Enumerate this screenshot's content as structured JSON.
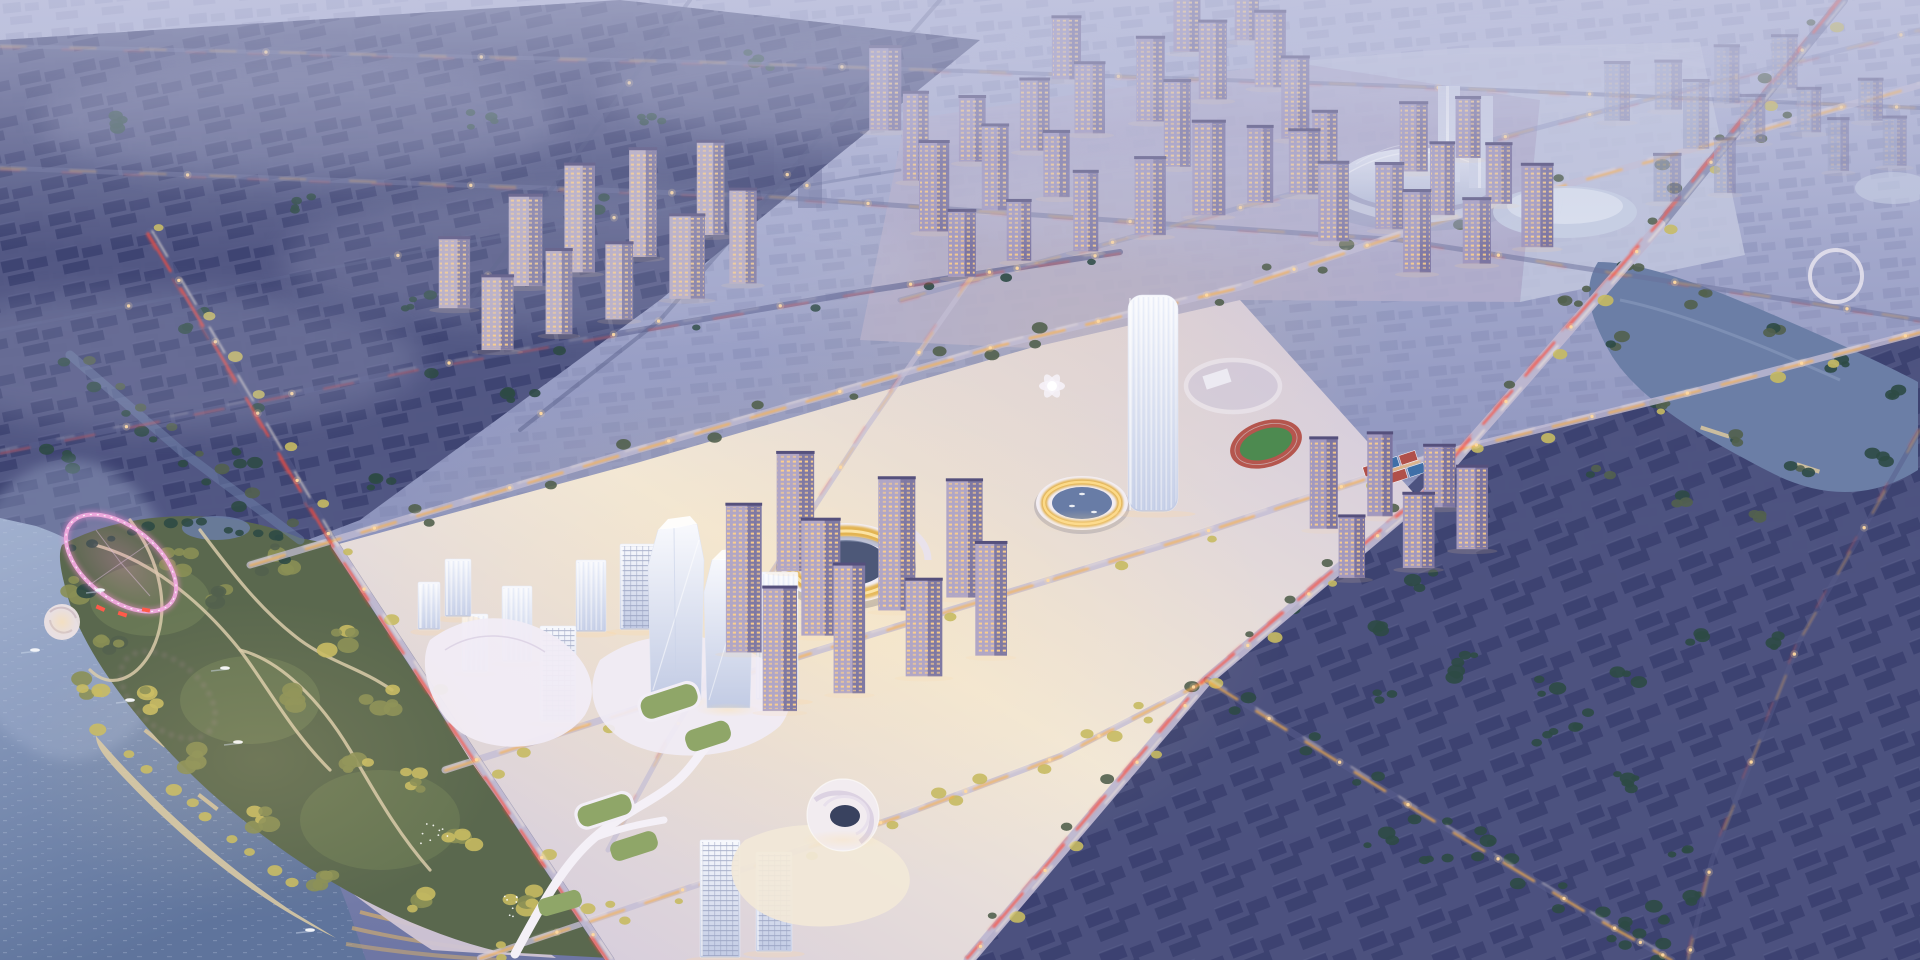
{
  "scene": {
    "description": "Oblique aerial rendering at dusk of a new-town masterplan: an illuminated CBD with twin faceted glass supertall towers, a gold-ringed stadium, a circular canal marina, schools with running track, lit residential tower clusters, a lakeside park with a glowing pink loop sculpture, all surrounded by a hazy existing city grid crossed by light-streaked arterial roads",
    "time_of_day": "dusk",
    "view": "aerial-oblique",
    "districts": [
      "hazy-far-city-north",
      "dark-old-city-northwest",
      "lit-residential-north",
      "cbd-core",
      "residential-south",
      "dark-district-southeast",
      "riverside-pond-east",
      "lakefront-park-west"
    ],
    "landmarks": [
      "twisting-glass-tower-a",
      "twisting-glass-tower-b",
      "ring-stadium-gold",
      "circular-canal-marina",
      "white-dome-arena",
      "twin-white-towers",
      "elliptical-glass-hall",
      "school-ellipse-walkway",
      "running-track",
      "sports-courts",
      "funnel-atrium-building",
      "elevated-green-walkway",
      "pink-light-loop",
      "amphitheater-disc",
      "waterfront-pools",
      "beach-arcs"
    ],
    "counts": {
      "boats_on_lake": 6,
      "canal_boats": 3,
      "pool_clusters": 2,
      "ring_structures": 3
    }
  },
  "palette": {
    "sky_top": "#b7bbd9",
    "sky_mid": "#979dc4",
    "sky_low": "#828ab4",
    "horizon": "#6e76a4",
    "fog": "#c6c9e2",
    "far_block": "#7d83ad",
    "old_base": "#4c517e",
    "old_block": "#3a3f6e",
    "se_block": "#3a3f6e",
    "se_base": "#4a4f7c",
    "tree_dark": "#2e4a45",
    "tree_dusk": "#52604e",
    "tree_olive": "#8a8f55",
    "tree_lit": "#c6ba62",
    "water_top": "#9dadcc",
    "water_deep": "#5f749c",
    "pond": "#6b7ea6",
    "road_dark": "#565c8a",
    "road_light": "#c3bdd4",
    "streak_red": "#ff4a38",
    "streak_amber": "#ffb347",
    "streak_white": "#fff3e0",
    "lamp": "#ffd9a0",
    "cbd_edge": "#cfc6dd",
    "cbd_core": "#f2e8d8",
    "res_ground": "#b3aecb",
    "plaza_pale": "#c3c8de",
    "podium_white": "#f1ecf6",
    "glass_top": "#f8f9fd",
    "glass_bottom": "#c2cbe4",
    "green_roof": "#8fa668",
    "field_green": "#4d8a50",
    "track_red": "#b5564e",
    "court_red": "#b0504a",
    "court_blue": "#3f6fa8",
    "gold": "#e2b04a",
    "gold_glow": "#ffdf9e",
    "res_wall": "#a299bf",
    "res_wall_light": "#b9aec4",
    "res_shade": "#6f6997",
    "roof_dark": "#55507c",
    "win_amber": "#ffd08a",
    "win_cool": "#cfd9f2",
    "pink": "#f0a9dd",
    "pink_glow": "#ff8fd8",
    "path_beige": "#d9cbaa",
    "pool_blue": "#4b86c4",
    "sand": "#d8c9a4",
    "boat_white": "#f2f4f8"
  }
}
